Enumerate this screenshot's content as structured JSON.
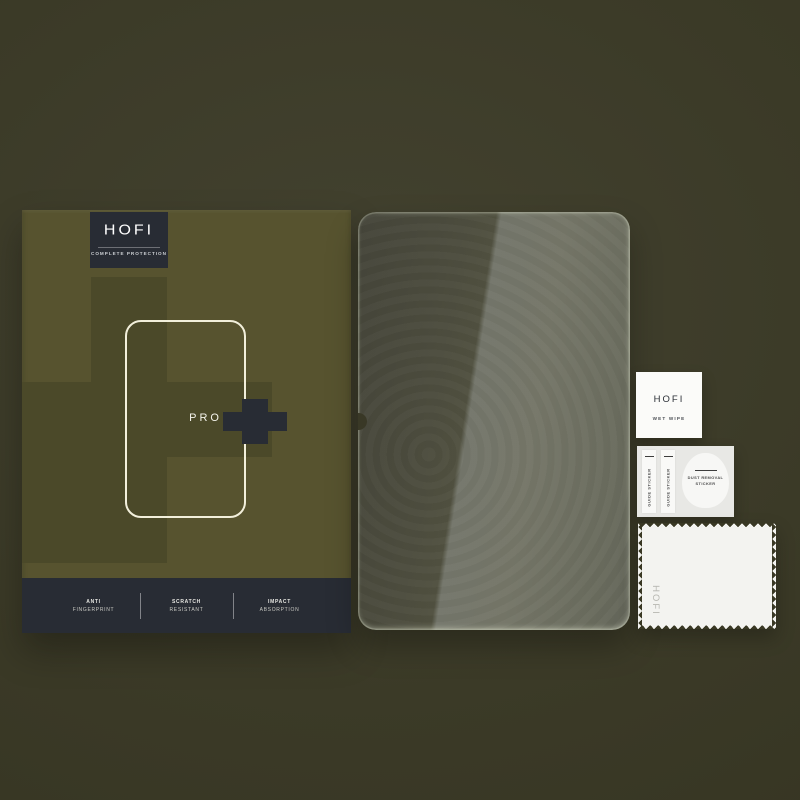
{
  "box": {
    "brand": "HOFI",
    "tagline": "COMPLETE PROTECTION",
    "model_label": "PRO",
    "features": [
      {
        "line1": "ANTI",
        "line2": "FINGERPRINT"
      },
      {
        "line1": "SCRATCH",
        "line2": "RESISTANT"
      },
      {
        "line1": "IMPACT",
        "line2": "ABSORPTION"
      }
    ]
  },
  "accessories": {
    "wet_wipe": {
      "brand": "HOFI",
      "label": "WET WIPE"
    },
    "sticker_sheet": {
      "guide_sticker_label": "GUIDE STICKER",
      "dust_line1": "DUST REMOVAL",
      "dust_line2": "STICKER"
    },
    "cloth": {
      "brand": "HOFI"
    }
  },
  "colors": {
    "background": "#3b3a27",
    "box_base": "#57532f",
    "box_pattern": "#4b4929",
    "panel_dark": "#282c34",
    "outline_cream": "#f2efdb",
    "glass_dark": "#4c4c3e",
    "glass_light": "#73756a",
    "accessory_white": "#f6f6f3"
  }
}
